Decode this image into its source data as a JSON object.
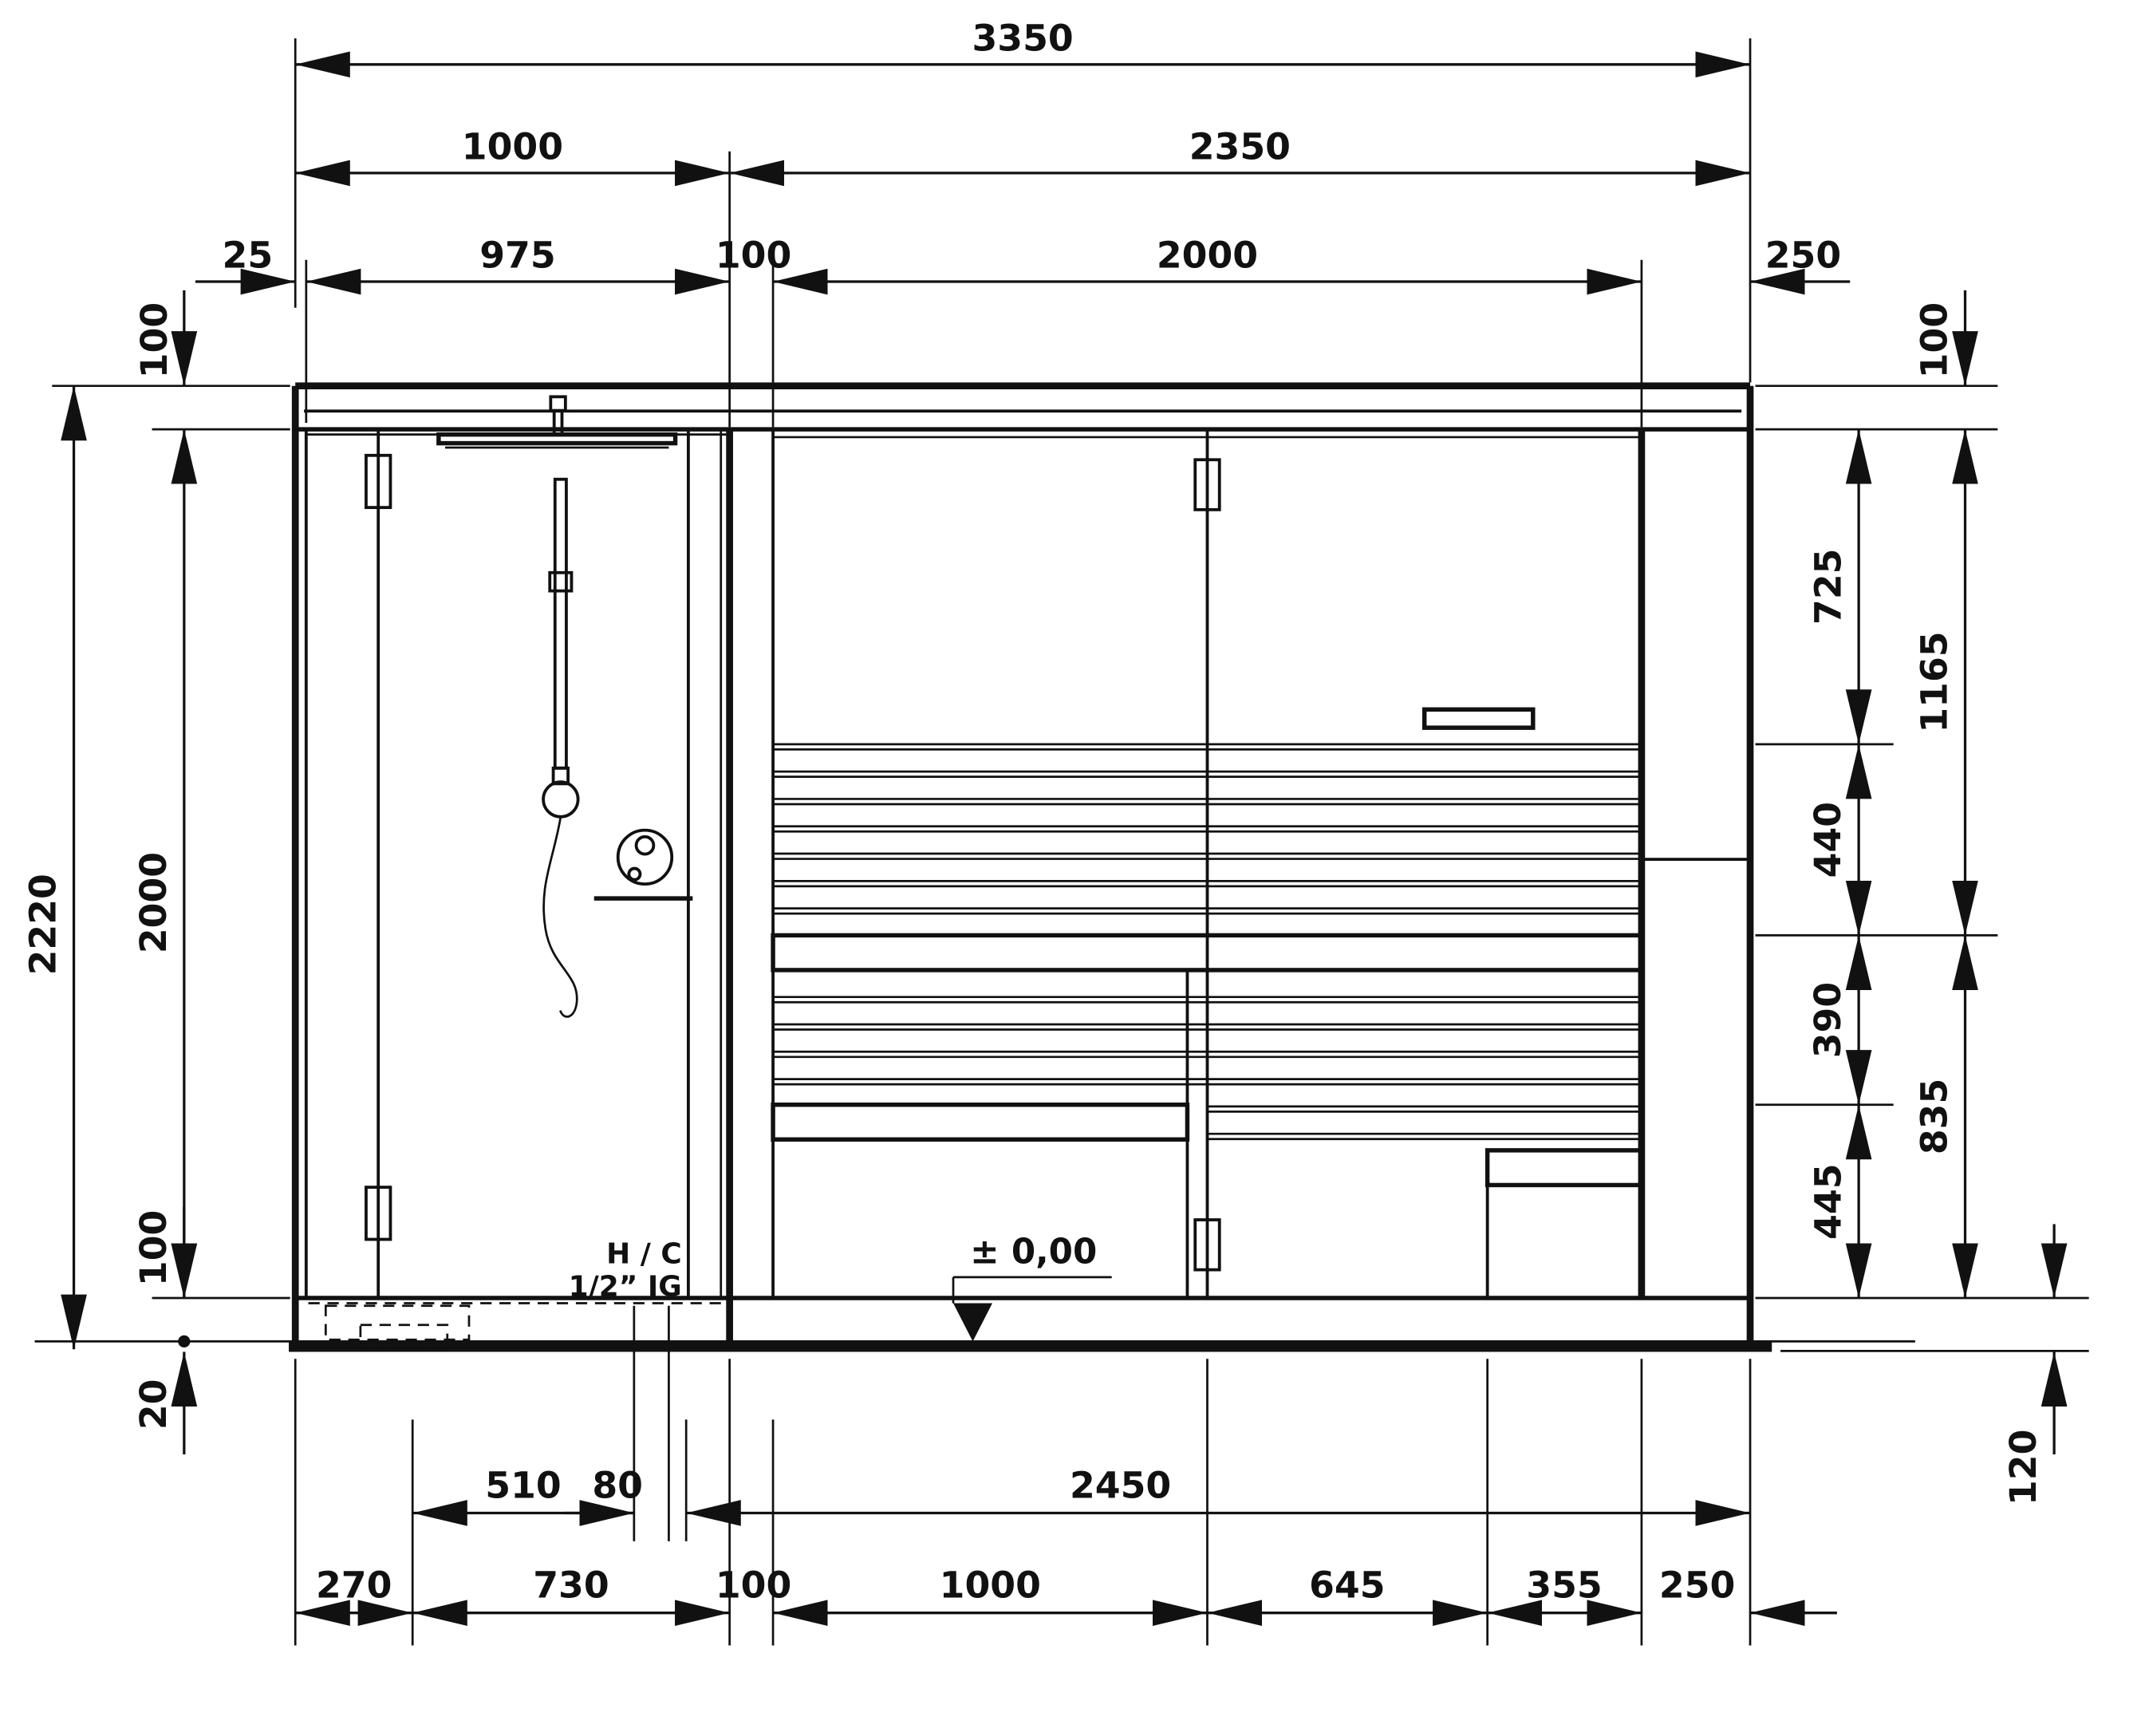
{
  "page": {
    "background": "#ffffff",
    "line_color": "#111111"
  },
  "drawing": {
    "type": "technical-elevation",
    "subject": "sauna-with-shower-front-elevation",
    "dims": {
      "total_width": "3350",
      "shower_width": "1000",
      "sauna_width": "2350",
      "left_offset": "25",
      "shower_inner": "975",
      "post_top": "100",
      "glass_front": "2000",
      "right_zone_top": "250",
      "roof_left": "100",
      "roof_right": "100",
      "total_height": "2220",
      "interior_height": "2000",
      "bottom_left": "100",
      "base_left": "20",
      "backrest_top": "725",
      "upper_zone": "1165",
      "bench_gap": "440",
      "bench_step": "390",
      "lower_zone": "835",
      "lower_bench": "445",
      "base_right": "120",
      "b1_510": "510",
      "b1_80": "80",
      "b1_2450": "2450",
      "b2_270": "270",
      "b2_730": "730",
      "b2_100": "100",
      "b2_1000": "1000",
      "b2_645": "645",
      "b2_355": "355",
      "b2_250": "250"
    },
    "annotations": {
      "hc_line1": "H / C",
      "hc_line2": "1/2” IG",
      "datum": "± 0,00"
    }
  }
}
